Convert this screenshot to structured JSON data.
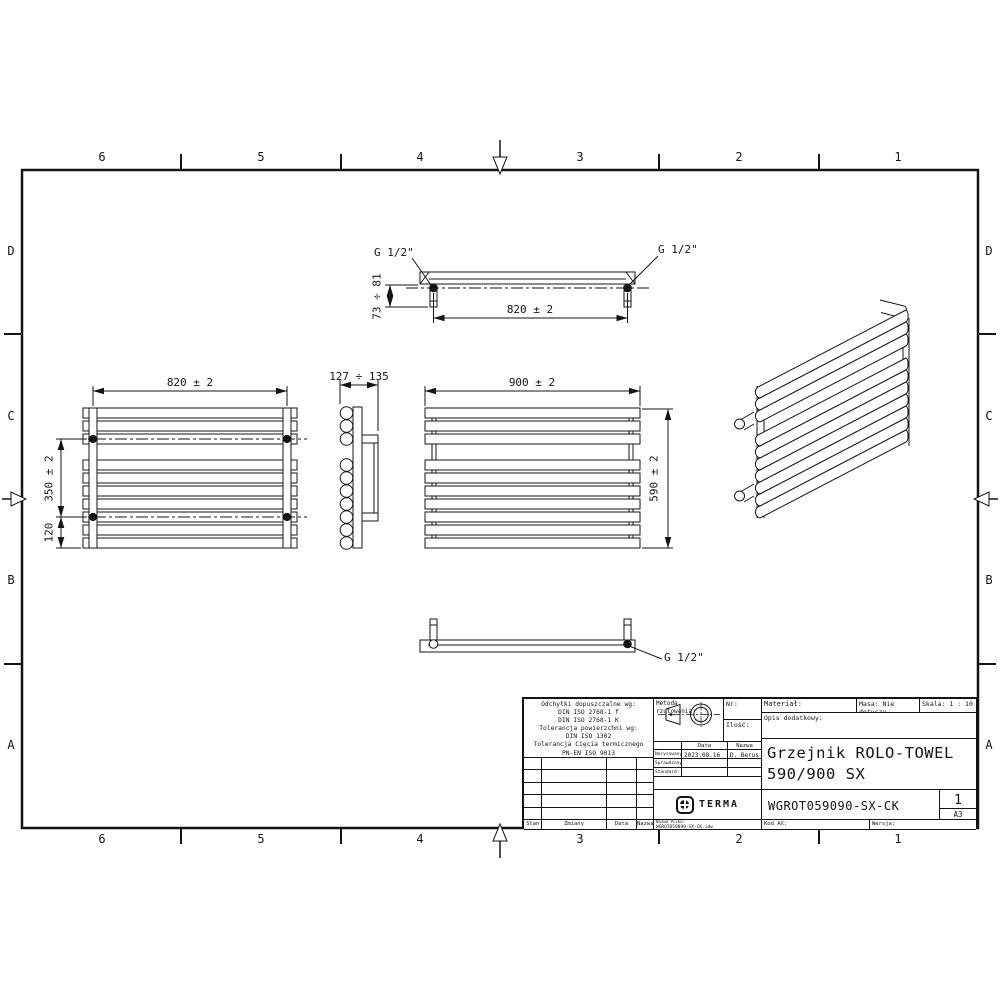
{
  "border": {
    "top_labels": [
      "6",
      "5",
      "4",
      "3",
      "2",
      "1"
    ],
    "bottom_labels": [
      "6",
      "5",
      "4",
      "3",
      "2",
      "1"
    ],
    "left_labels": [
      "D",
      "C",
      "B",
      "A"
    ],
    "right_labels": [
      "D",
      "C",
      "B",
      "A"
    ]
  },
  "dims": {
    "top_width": "820 ± 2",
    "top_depth": "73 ÷ 81",
    "rear_width": "820 ± 2",
    "conn_spacing": "350 ± 2",
    "bottom_offset": "120",
    "side_depth": "127 ÷ 135",
    "front_width": "900 ± 2",
    "front_height": "590 ± 2",
    "thread_size": "G 1/2\""
  },
  "title_block": {
    "tolerances": {
      "l1": "Odchyłki dopuszczalne wg:",
      "l2": "DIN ISO 2768-1 f",
      "l3": "DIN ISO 2768-1 K",
      "l4": "Tolerancja powierzchni wg:",
      "l5": "DIN ISO 1302",
      "l6": "Tolerancja Cięcia termicznego",
      "l7": "PN-EN ISO 9013"
    },
    "projection_label": "Metoda rzutowania:",
    "nr_label": "Nr:",
    "qty_label": "Ilość:",
    "material_label": "Materiał:",
    "mass_label": "Masa: Nie dotyczy",
    "scale_label": "Skala: 1 : 10",
    "description_label": "Opis dodatkowy:",
    "date_header": "Data",
    "name_header": "Nazwa",
    "drawn_label": "Narysowany",
    "drawn_date": "2023.08.16",
    "drawn_name": "D. Berus",
    "checked_label": "Sprawdzony",
    "standard_label": "Standard",
    "product_title_line1": "Grzejnik ROLO-TOWEL",
    "product_title_line2": "590/900 SX",
    "brand": "TERMA",
    "part_number": "WGROT059090-SX-CK",
    "sheet_number": "1",
    "paper_size": "A3",
    "stan_label": "Stan",
    "zmiany_label": "Zmiany",
    "data_label": "Data",
    "nazwa_label": "Nazwa",
    "file_label": "Nazwa Pliku:",
    "file_name": "WGROT059090-SX-CK.idw",
    "kod_label": "Kod AX:",
    "wersja_label": "Wersja:"
  }
}
